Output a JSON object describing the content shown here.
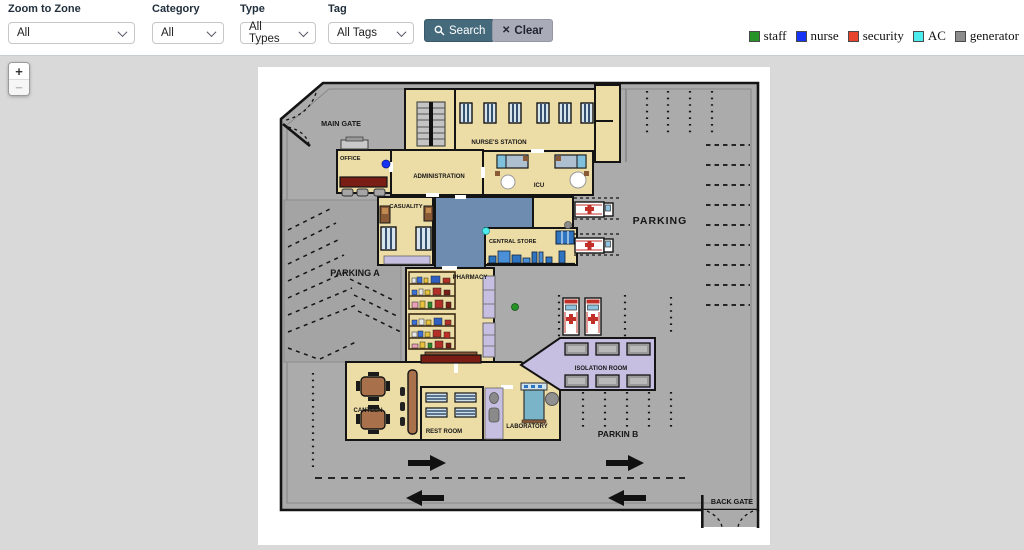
{
  "toolbar": {
    "filters": [
      {
        "label": "Zoom to Zone",
        "value": "All"
      },
      {
        "label": "Category",
        "value": "All"
      },
      {
        "label": "Type",
        "value": "All Types"
      },
      {
        "label": "Tag",
        "value": "All Tags"
      }
    ],
    "search_label": "Search",
    "clear_label": "Clear"
  },
  "legend": {
    "items": [
      {
        "label": "staff",
        "color": "#269326"
      },
      {
        "label": "nurse",
        "color": "#1633f5"
      },
      {
        "label": "security",
        "color": "#e8432d"
      },
      {
        "label": "AC",
        "color": "#4deded"
      },
      {
        "label": "generator",
        "color": "#8c8c8c"
      }
    ]
  },
  "zoom_control": {
    "zoom_in": "+",
    "zoom_out": "−"
  },
  "map": {
    "labels": {
      "main_gate": "MAIN GATE",
      "nurses_station": "NURSE'S STATION",
      "office": "OFFICE",
      "administration": "ADMINISTRATION",
      "icu": "ICU",
      "casuality": "CASUALITY",
      "central_store": "CENTRAL STORE",
      "parking": "PARKING",
      "parking_a": "PARKING A",
      "pharmacy": "PHARMACY",
      "isolation_room": "ISOLATION ROOM",
      "canteen": "CANTEEN",
      "rest_room": "REST ROOM",
      "laboratory": "LABORATORY",
      "parkin_b": "PARKIN B",
      "back_gate": "BACK GATE"
    },
    "markers": [
      {
        "type": "nurse",
        "color": "#1633f5"
      },
      {
        "type": "AC",
        "color": "#4deded"
      },
      {
        "type": "generator",
        "color": "#8c8c8c"
      },
      {
        "type": "staff",
        "color": "#269326"
      }
    ]
  }
}
